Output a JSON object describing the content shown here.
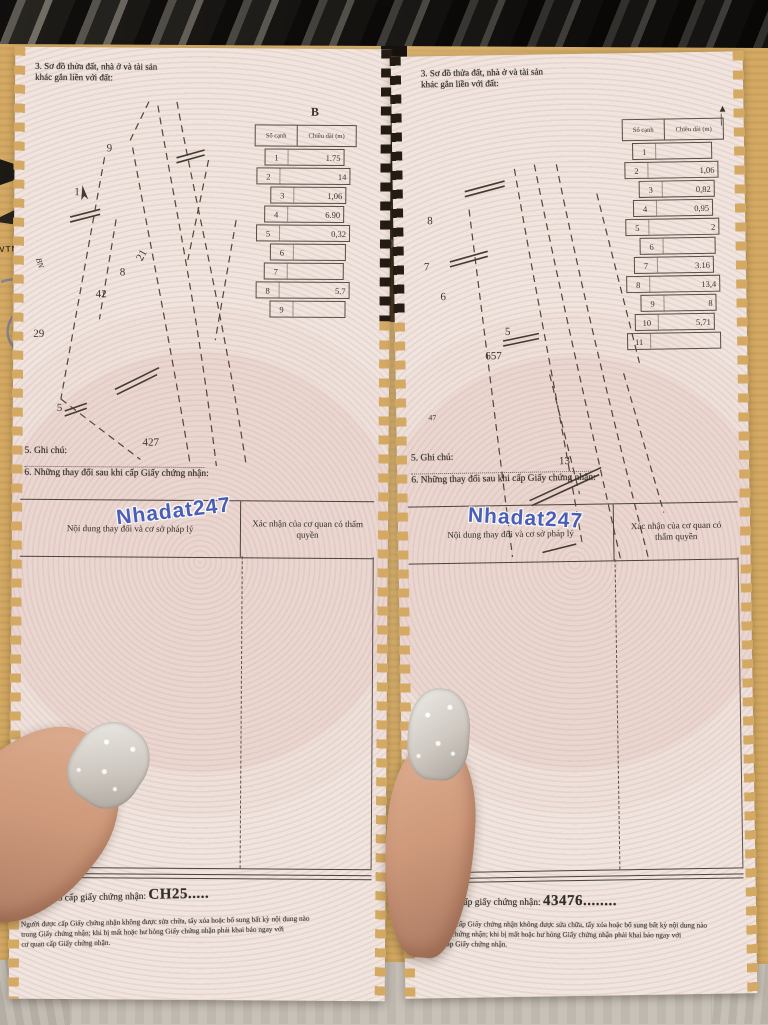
{
  "watermark": {
    "text": "Nhadat247",
    "color_hex": "#3d55b5"
  },
  "envelope": {
    "color_hex": "#d3a963",
    "left_text": "VTNAM"
  },
  "left_page": {
    "heading_line1": "3. Sơ đồ thửa đất, nhà ở và tài sản",
    "heading_line2": "khác gắn liền với đất:",
    "north_label": "B",
    "sketch_labels": {
      "n9": "9",
      "n1": "1",
      "n8": "8",
      "n42": "42",
      "n21": "21",
      "n29": "29",
      "n5": "5",
      "n427": "427",
      "bn": "BN"
    },
    "edge_table": {
      "col1": "Số cạnh",
      "col2": "Chiều dài (m)",
      "rows": [
        {
          "n": "1",
          "len": "1.75"
        },
        {
          "n": "2",
          "len": "14"
        },
        {
          "n": "3",
          "len": "1,06"
        },
        {
          "n": "4",
          "len": "6.90"
        },
        {
          "n": "5",
          "len": "0,32"
        },
        {
          "n": "6",
          "len": ""
        },
        {
          "n": "7",
          "len": ""
        },
        {
          "n": "8",
          "len": "5.7"
        },
        {
          "n": "9",
          "len": ""
        }
      ]
    },
    "notes_line1": "5. Ghi chú:",
    "notes_line2": "6. Những thay đổi sau khi cấp Giấy chứng nhận:",
    "change_table": {
      "col1": "Nội dung thay đổi và cơ sở pháp lý",
      "col2": "Xác nhận của cơ quan có thẩm quyền"
    },
    "serial_label": "Số vào sổ cấp giấy chứng nhận:",
    "serial_number": "CH25.....",
    "fine_print": [
      {
        "t": "Người được cấp Giấy chứng nhận không được sửa chữa, tẩy xóa hoặc bổ sung bất kỳ nội dung nào"
      },
      {
        "t": "trong Giấy chứng nhận; khi bị mất hoặc hư hỏng Giấy chứng nhận phải khai báo ngay với"
      },
      {
        "t": "cơ quan cấp Giấy chứng nhận."
      }
    ]
  },
  "right_page": {
    "heading_line1": "3. Sơ đồ thửa đất, nhà ở và tài sản",
    "heading_line2": "khác gắn liền với đất:",
    "sketch_labels": {
      "n8": "8",
      "n7": "7",
      "n6": "6",
      "n657": "657",
      "n5": "5",
      "n13": "13",
      "n47": "47"
    },
    "edge_table": {
      "col1": "Số cạnh",
      "col2": "Chiều dài (m)",
      "rows": [
        {
          "n": "1",
          "len": ""
        },
        {
          "n": "2",
          "len": "1,06"
        },
        {
          "n": "3",
          "len": "0,82"
        },
        {
          "n": "4",
          "len": "0,95"
        },
        {
          "n": "5",
          "len": "2"
        },
        {
          "n": "6",
          "len": ""
        },
        {
          "n": "7",
          "len": "3.16"
        },
        {
          "n": "8",
          "len": "13,4"
        },
        {
          "n": "9",
          "len": "8"
        },
        {
          "n": "10",
          "len": "5,71"
        },
        {
          "n": "11",
          "len": ""
        }
      ]
    },
    "notes_line1": "5. Ghi chú:",
    "notes_line2": "6. Những thay đổi sau khi cấp Giấy chứng nhận:",
    "change_table": {
      "col1": "Nội dung thay đổi và cơ sở pháp lý",
      "col2": "Xác nhận của cơ quan có thẩm quyền"
    },
    "serial_label": "Số vào sổ cấp giấy chứng nhận:",
    "serial_number": "43476........",
    "fine_print": [
      {
        "t": "Người được cấp Giấy chứng nhận không được sửa chữa, tẩy xóa hoặc bổ sung bất kỳ nội dung nào"
      },
      {
        "t": "trong Giấy chứng nhận; khi bị mất hoặc hư hỏng Giấy chứng nhận phải khai báo ngay với"
      },
      {
        "t": "cơ quan cấp Giấy chứng nhận."
      }
    ]
  }
}
